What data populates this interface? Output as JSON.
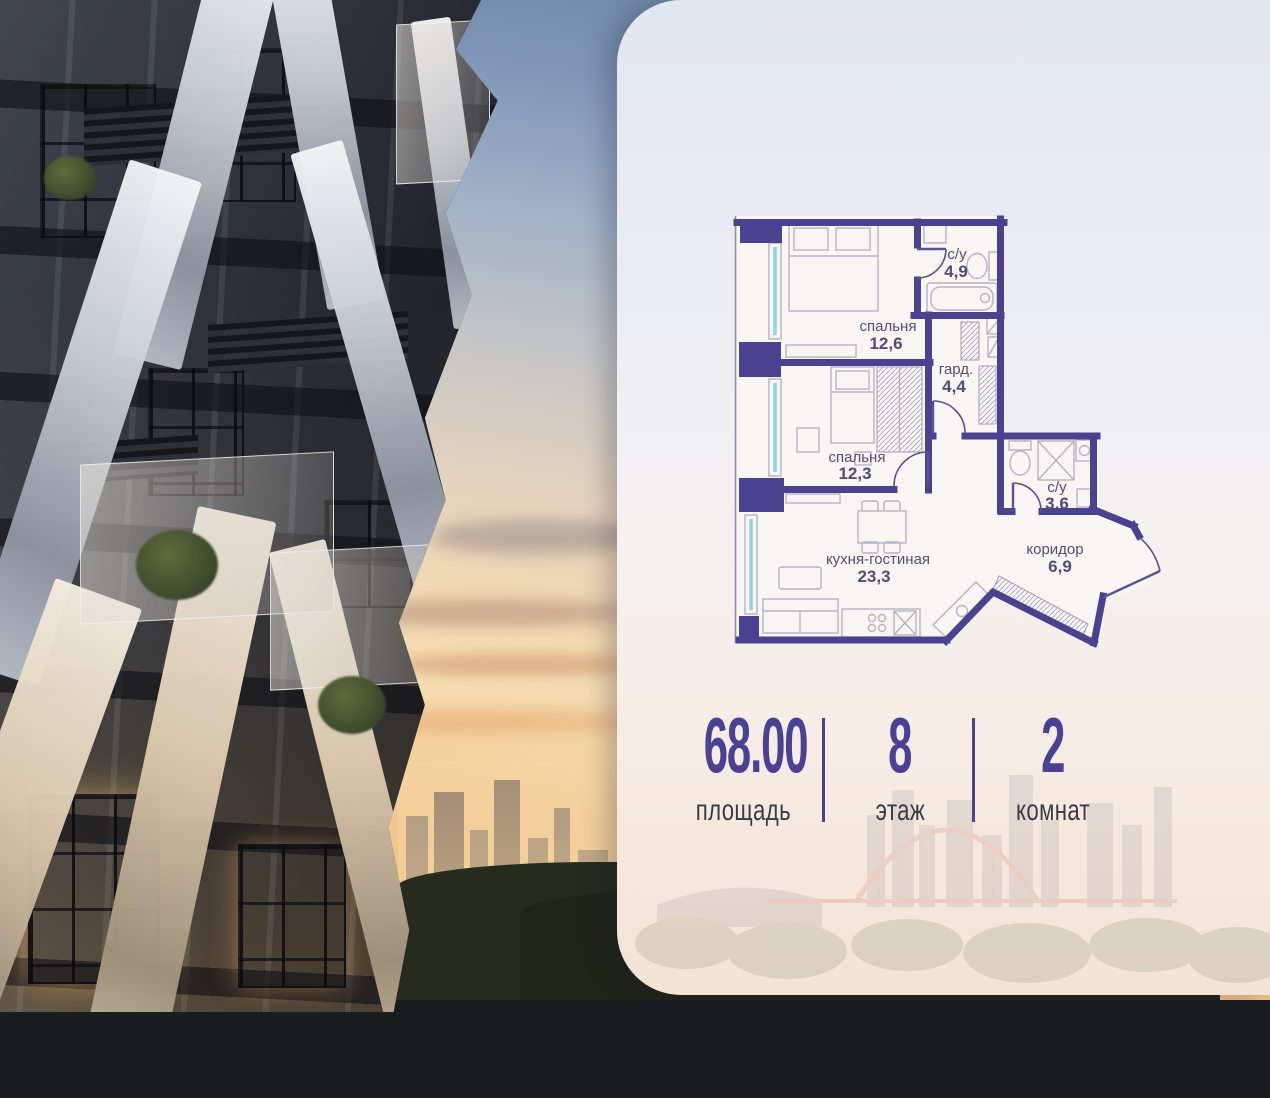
{
  "card": {
    "floor_plan": {
      "rooms": [
        {
          "name": "спальня",
          "area": "12,6"
        },
        {
          "name": "с/у",
          "area": "4,9"
        },
        {
          "name": "гард.",
          "area": "4,4"
        },
        {
          "name": "спальня",
          "area": "12,3"
        },
        {
          "name": "кухня-гостиная",
          "area": "23,3"
        },
        {
          "name": "с/у",
          "area": "3,6"
        },
        {
          "name": "коридор",
          "area": "6,9"
        }
      ]
    },
    "stats": {
      "items": [
        {
          "value": "68.00",
          "label": "площадь"
        },
        {
          "value": "8",
          "label": "этаж"
        },
        {
          "value": "2",
          "label": "комнат"
        }
      ]
    }
  },
  "colors": {
    "accent_purple": "#4b4194",
    "plan_wall": "#4a428f",
    "stat_label": "#3b3b40",
    "window_glass": "#8ed2ea"
  }
}
